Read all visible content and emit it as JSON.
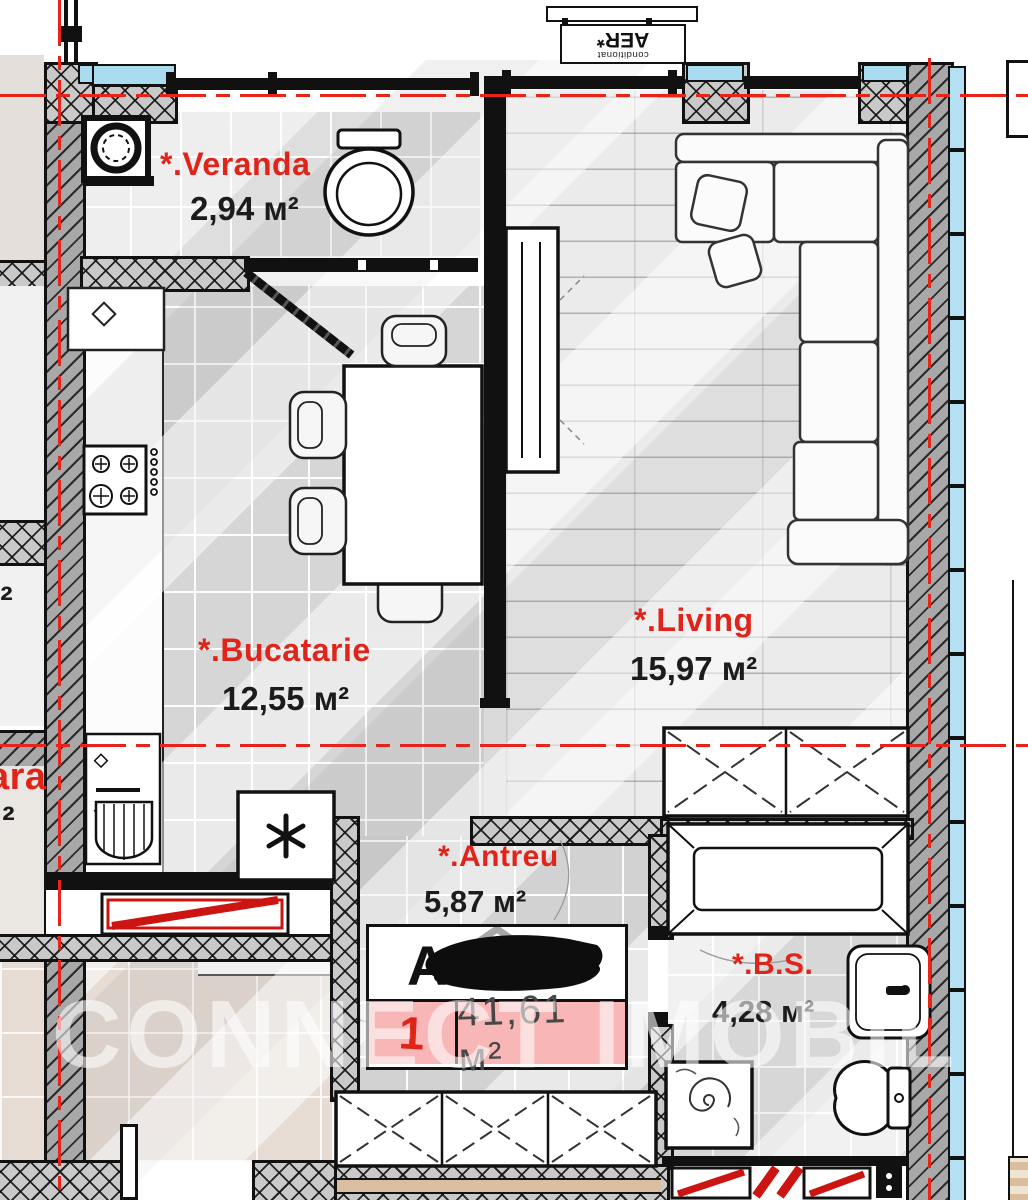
{
  "watermark": "CONNECT IMOBIL",
  "ac_unit": {
    "label": "AER*",
    "sublabel": "conditionat"
  },
  "rooms": [
    {
      "id": "veranda",
      "name": "*.Veranda",
      "area": "2,94 м²"
    },
    {
      "id": "bucatarie",
      "name": "*.Bucatarie",
      "area": "12,55 м²"
    },
    {
      "id": "living",
      "name": "*.Living",
      "area": "15,97 м²"
    },
    {
      "id": "antreu",
      "name": "*.Antreu",
      "area": "5,87 м²"
    },
    {
      "id": "bs",
      "name": "*.B.S.",
      "area": "4,28 м²"
    }
  ],
  "apartment_badge": {
    "redacted_prefix": "A",
    "number": "1",
    "total_area": "41,61 м²"
  },
  "partial_labels": {
    "left_top_area_fragment": "м²",
    "left_room_name_fragment": "ara",
    "left_room_area_fragment": "м²"
  },
  "colors": {
    "accent_red": "#e0241a",
    "axis_red": "#e8231a",
    "badge_pink": "#f8b6b6",
    "window_blue": "#aadcf0",
    "text_black": "#1c1c1c",
    "watermark_white": "rgba(255,255,255,0.58)"
  }
}
